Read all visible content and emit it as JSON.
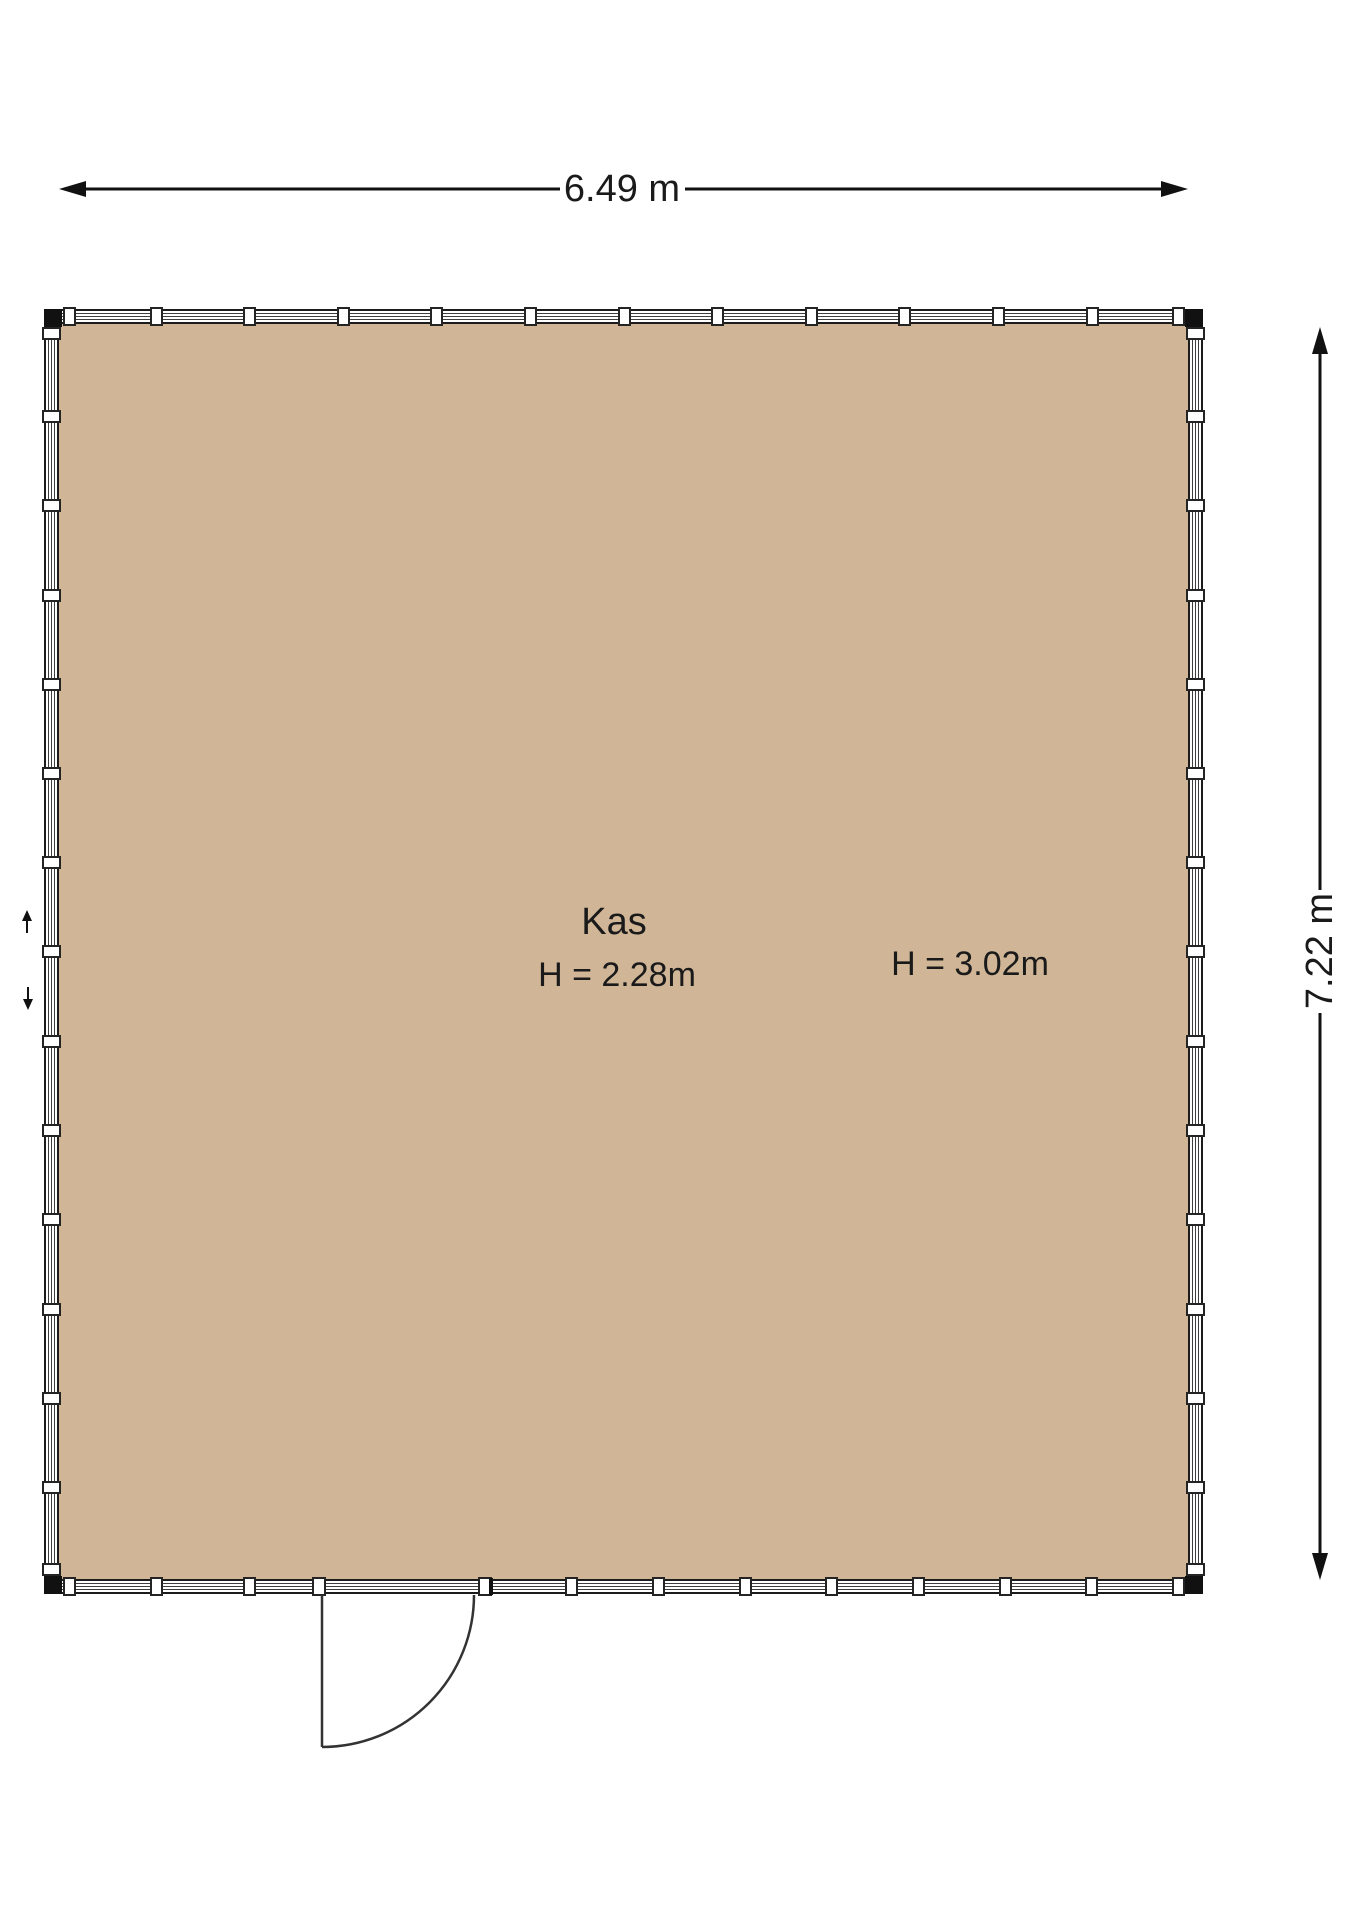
{
  "room": {
    "name": "Kas",
    "height_label_primary": "H = 2.28m",
    "height_label_secondary": "H = 3.02m"
  },
  "dimensions": {
    "width_label": "6.49 m",
    "height_label": "7.22 m",
    "width_meters": 6.49,
    "height_meters": 7.22,
    "ceiling_height_primary_m": 2.28,
    "ceiling_height_secondary_m": 3.02
  },
  "colors": {
    "floor_fill": "#d0b697",
    "wall_outline": "#1c1c1c",
    "glazing_line": "#3f3f3f",
    "dimension_ink": "#111111",
    "background": "#ffffff"
  }
}
